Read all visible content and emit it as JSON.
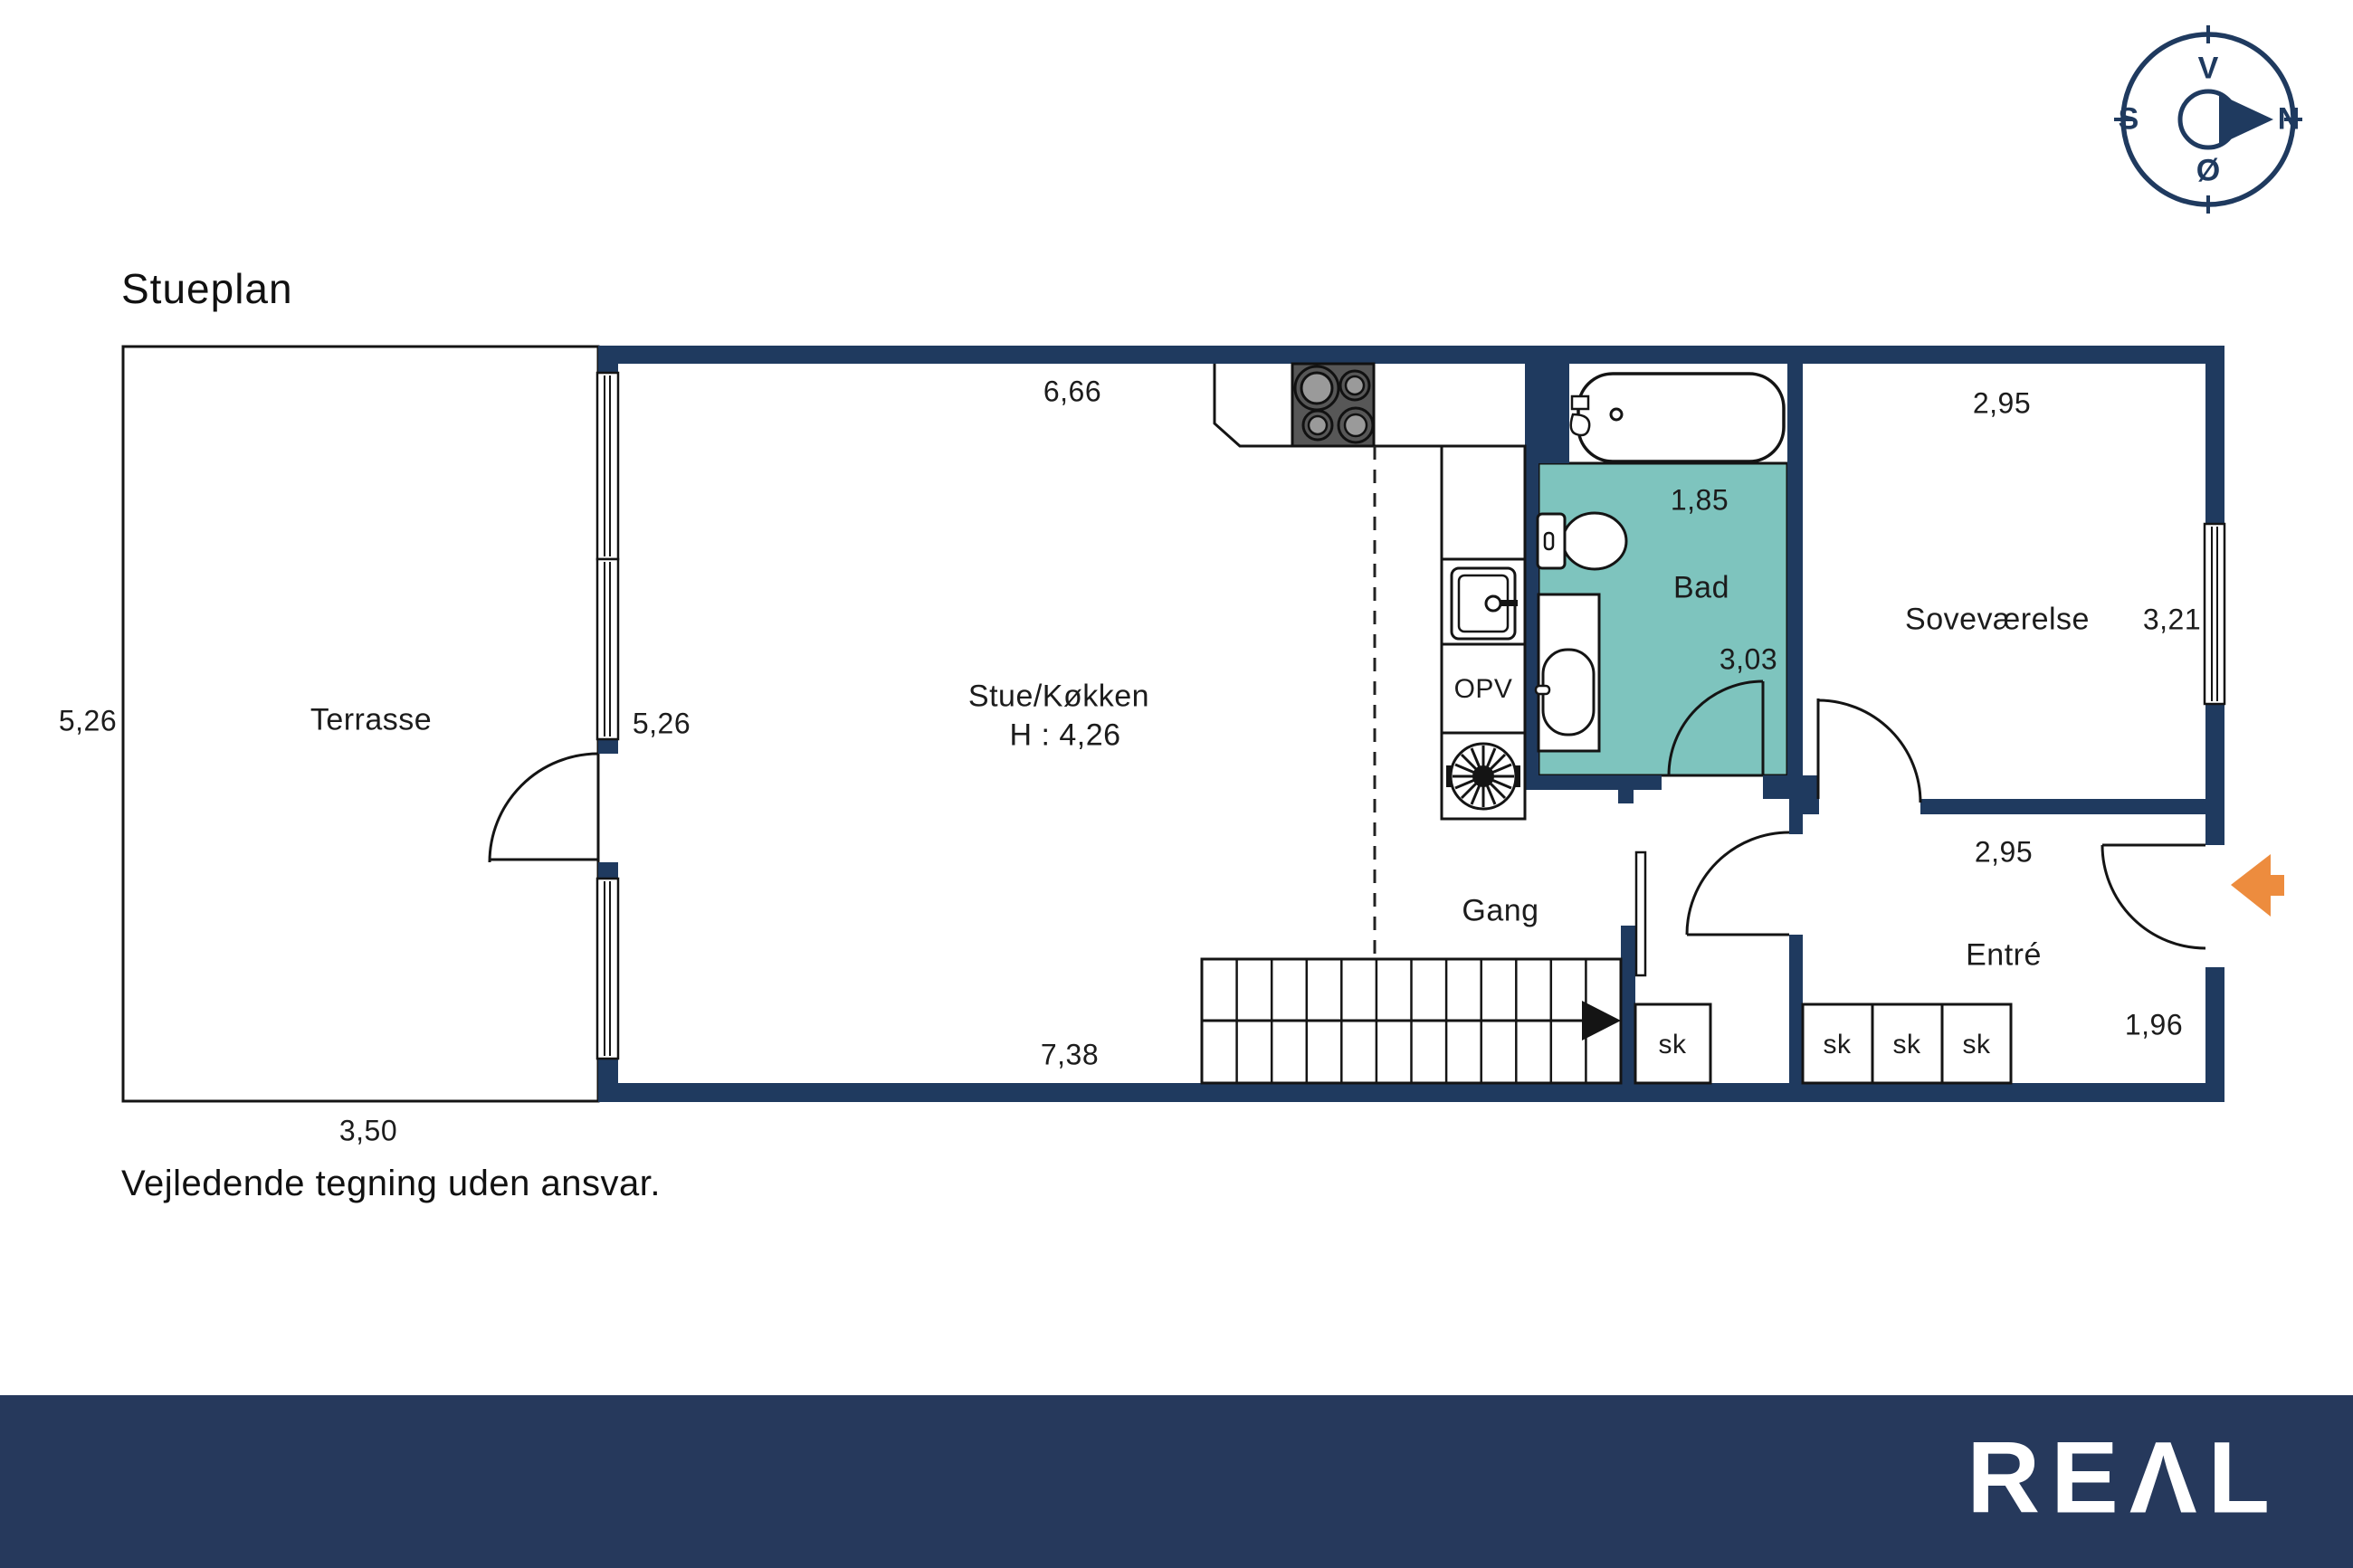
{
  "page": {
    "title": "Stueplan",
    "disclaimer": "Vejledende tegning uden ansvar."
  },
  "compass": {
    "top": "V",
    "right": "N",
    "bottom": "Ø",
    "left": "S"
  },
  "rooms": {
    "terrasse": {
      "name": "Terrasse",
      "side_dim": "5,26",
      "bottom_dim": "3,50"
    },
    "stue_kokken": {
      "name": "Stue/Køkken",
      "ceiling_height": "H : 4,26",
      "top_dim": "6,66",
      "bottom_dim": "7,38",
      "side_dim": "5,26"
    },
    "bad": {
      "name": "Bad",
      "top_dim": "1,85",
      "side_dim": "3,03"
    },
    "sovevaerelse": {
      "name": "Soveværelse",
      "top_dim": "2,95",
      "side_dim": "3,21"
    },
    "entre": {
      "name": "Entré",
      "top_dim": "2,95",
      "side_dim": "1,96"
    },
    "gang": {
      "name": "Gang"
    }
  },
  "fixtures": {
    "dishwasher_label": "OPV",
    "closet_label": "sk"
  },
  "branding": {
    "logo": "REAL",
    "logo_glyphs": "REΛL"
  },
  "colors": {
    "wall_navy": "#1F3A5F",
    "bathroom_teal": "#7EC4BE",
    "entry_arrow_orange": "#ED8C3E",
    "footer_navy": "#26395C"
  }
}
